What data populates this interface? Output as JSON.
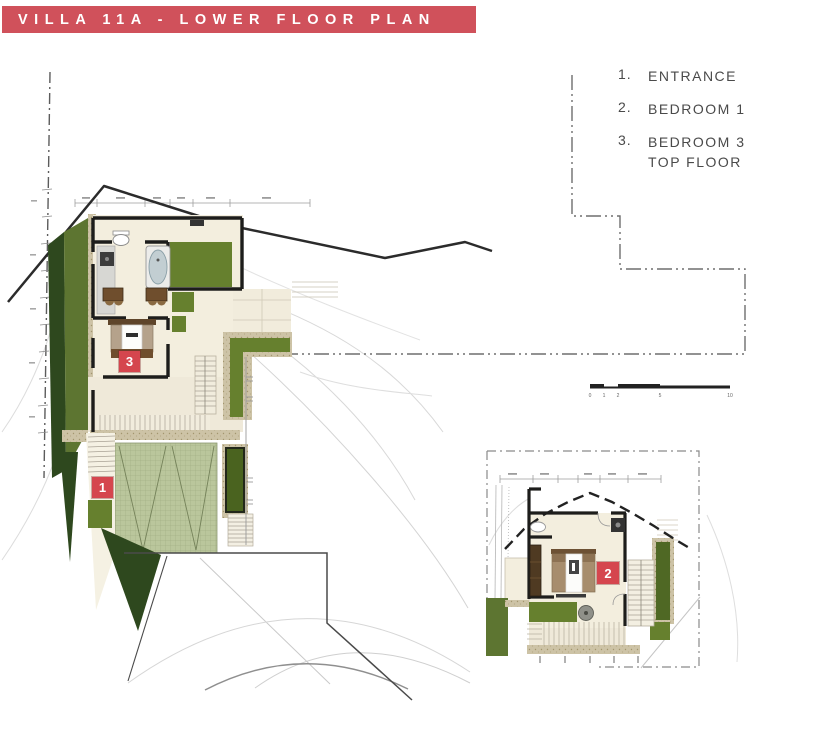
{
  "header": {
    "title": "VILLA 11A - LOWER FLOOR PLAN"
  },
  "legend": {
    "items": [
      {
        "number": "1.",
        "label": "ENTRANCE",
        "label2": ""
      },
      {
        "number": "2.",
        "label": "BEDROOM 1",
        "label2": ""
      },
      {
        "number": "3.",
        "label": "BEDROOM 3",
        "label2": "TOP FLOOR"
      }
    ]
  },
  "markers": {
    "entrance": {
      "number": "1"
    },
    "bedroom1": {
      "number": "2"
    },
    "bedroom3": {
      "number": "3"
    }
  },
  "scale_bar": {
    "labels": [
      "0",
      "1",
      "2",
      "5",
      "10"
    ]
  },
  "colors": {
    "banner_red": "#d0515b",
    "marker_red": "#d5464e",
    "wall_black": "#1d1d1b",
    "grass_olive": "#66802e",
    "grass_dark": "#2e481e",
    "paver_sage": "#bac69c",
    "floor_cream": "#f3eede",
    "stone_tan": "#cdc3a6",
    "contour_gray": "#d8d8d8",
    "boundary_gray": "#6e6e6e",
    "legend_text": "#4a4a4a"
  }
}
